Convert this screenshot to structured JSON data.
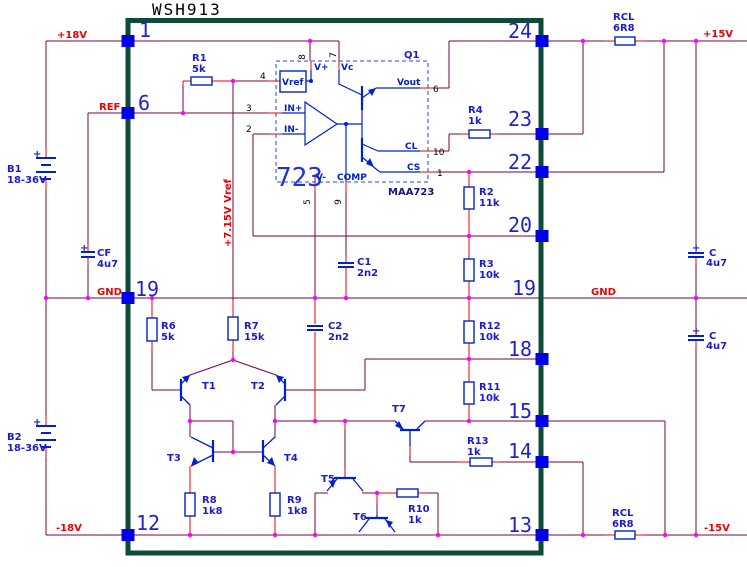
{
  "title": "WSH913",
  "pins": {
    "left": [
      "1",
      "6",
      "19",
      "12"
    ],
    "right": [
      "24",
      "23",
      "22",
      "20",
      "19",
      "18",
      "15",
      "14",
      "13"
    ]
  },
  "power": {
    "p18v": "+18V",
    "m18v": "-18V",
    "p15v": "+15V",
    "m15v": "-15V",
    "gnd_left": "GND",
    "gnd_right": "GND",
    "ref": "REF",
    "vref_rail": "+7.15V Vref"
  },
  "ic": {
    "big": "723",
    "part": "MAA723",
    "q1": "Q1",
    "vref": "Vref",
    "vplus": "V+",
    "vc": "Vc",
    "inp": "IN+",
    "inn": "IN-",
    "vminus": "V-",
    "comp": "COMP",
    "cl": "CL",
    "cs": "CS",
    "vout": "Vout",
    "pin_numbers": {
      "n8": "8",
      "n7": "7",
      "n4": "4",
      "n3": "3",
      "n2": "2",
      "n5": "5",
      "n9": "9",
      "n10": "10",
      "n1": "1",
      "n6": "6"
    }
  },
  "components": {
    "plus": "+",
    "r1": {
      "name": "R1",
      "value": "5k"
    },
    "r2": {
      "name": "R2",
      "value": "11k"
    },
    "r3": {
      "name": "R3",
      "value": "10k"
    },
    "r4": {
      "name": "R4",
      "value": "1k"
    },
    "r6": {
      "name": "R6",
      "value": "5k"
    },
    "r7": {
      "name": "R7",
      "value": "15k"
    },
    "r8": {
      "name": "R8",
      "value": "1k8"
    },
    "r9": {
      "name": "R9",
      "value": "1k8"
    },
    "r10": {
      "name": "R10",
      "value": "1k"
    },
    "r11": {
      "name": "R11",
      "value": "10k"
    },
    "r12": {
      "name": "R12",
      "value": "10k"
    },
    "r13": {
      "name": "R13",
      "value": "1k"
    },
    "rcl_top": {
      "name": "RCL",
      "value": "6R8"
    },
    "rcl_bot": {
      "name": "RCL",
      "value": "6R8"
    },
    "c1": {
      "name": "C1",
      "value": "2n2"
    },
    "c2": {
      "name": "C2",
      "value": "2n2"
    },
    "cf": {
      "name": "CF",
      "value": "4u7"
    },
    "c_top": {
      "name": "C",
      "value": "4u7"
    },
    "c_bot": {
      "name": "C",
      "value": "4u7"
    },
    "b1": {
      "name": "B1",
      "value": "18-36V"
    },
    "b2": {
      "name": "B2",
      "value": "18-36V"
    }
  },
  "transistors": {
    "t1": "T1",
    "t2": "T2",
    "t3": "T3",
    "t4": "T4",
    "t5": "T5",
    "t6": "T6",
    "t7": "T7"
  },
  "colors": {
    "wire": "#7a0045",
    "stub": "#f40000",
    "junction": "#ff00ff",
    "component": "#0022cc",
    "pad": "#0000e8",
    "border": "#0d4a3a"
  }
}
